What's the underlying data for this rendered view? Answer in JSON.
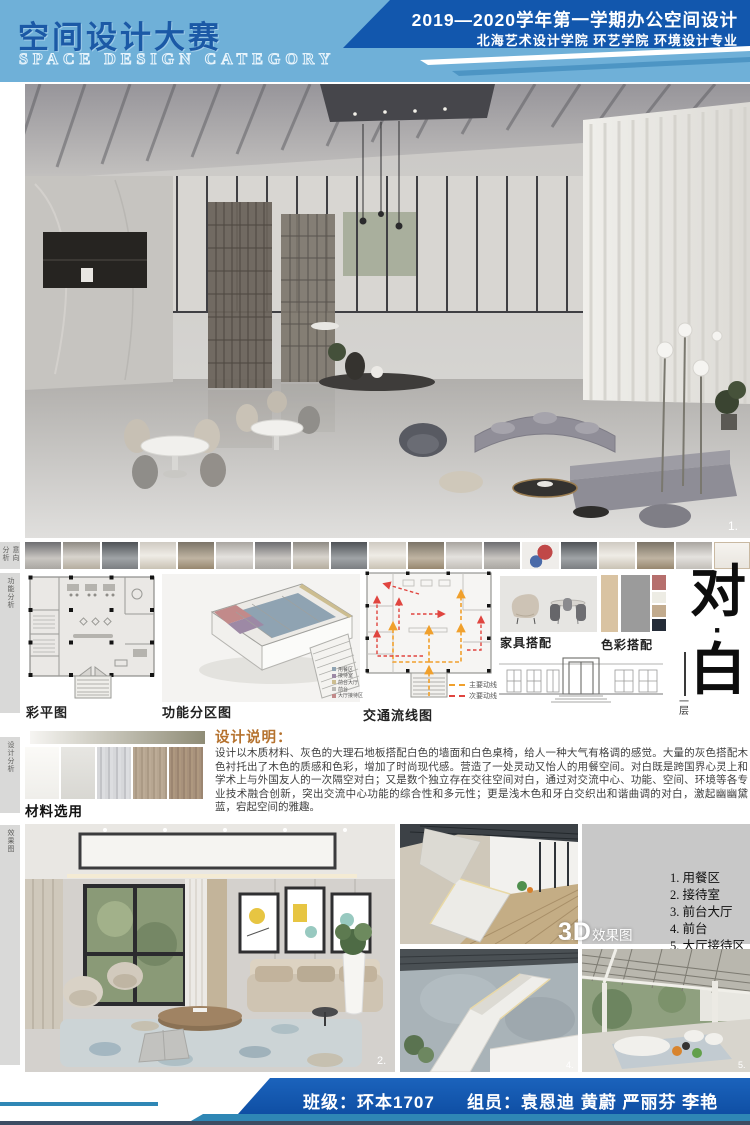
{
  "header": {
    "title_cn": "空间设计大赛",
    "title_en": "SPACE DESIGN CATEGORY",
    "course": "2019—2020学年第一学期办公空间设计",
    "school": "北海艺术设计学院 环艺学院 环境设计专业",
    "colors": {
      "bg_light_blue": "#6fb0d8",
      "band_dark_blue": "#1257ad",
      "title_blue": "#1b59a6"
    }
  },
  "side_tabs": [
    {
      "label": "意向分析"
    },
    {
      "label": "功能分析"
    },
    {
      "label": "设计分析"
    },
    {
      "label": "效果图"
    }
  ],
  "figures": {
    "floor_plan_label": "彩平图",
    "zoning_label": "功能分区图",
    "zoning_legend": [
      {
        "label": "用餐区",
        "color": "#8fa3b2"
      },
      {
        "label": "接待室",
        "color": "#9d89a5"
      },
      {
        "label": "前台大厅",
        "color": "#ccbd90"
      },
      {
        "label": "前台",
        "color": "#b9b8b4"
      },
      {
        "label": "大厅接待区",
        "color": "#c28a8a"
      }
    ],
    "traffic_label": "交通流线图",
    "traffic_legend": [
      {
        "label": "主要动线",
        "color": "#f0a02c"
      },
      {
        "label": "次要动线",
        "color": "#e0453f"
      }
    ],
    "furniture_label": "家具搭配",
    "palette_label": "色彩搭配",
    "palette_large": [
      "#d9c3a2",
      "#9b9b9b"
    ],
    "palette_small": [
      "#b66f6d",
      "#edece4",
      "#c2ab8e",
      "#252c38"
    ]
  },
  "theme": {
    "char_top": "对",
    "dot": "·",
    "char_bottom": "白",
    "floor_note_top": "一",
    "floor_note_bottom": "层"
  },
  "description": {
    "title": "设计说明：",
    "body": "设计以木质材料、灰色的大理石地板搭配白色的墙面和白色桌椅，给人一种大气有格调的感觉。大量的灰色搭配木色衬托出了木色的质感和色彩，增加了时尚现代感。营造了一处灵动又怡人的用餐空间。对白既是跨国界心灵上和学术上与外国友人的一次隔空对白；又是数个独立存在交往空间对白，通过对交流中心、功能、空间、环境等各专业技术融合创新，突出交流中心功能的综合性和多元性；更是浅木色和牙白交织出和谐曲调的对白，激起幽幽黛蓝，宕起空间的雅趣。"
  },
  "materials": {
    "label": "材料选用"
  },
  "renders": {
    "overlay_3d": "3D",
    "overlay_3d_suffix": "效果图",
    "list": [
      "1. 用餐区",
      "2. 接待室",
      "3. 前台大厅",
      "4. 前台",
      "5. 大厅接待区"
    ],
    "numbers": {
      "hero": "1.",
      "living": "2.",
      "corridor": "3.",
      "stair": "4.",
      "patio": "5."
    }
  },
  "footer": {
    "class_info": "班级：环本1707",
    "members": "组员：袁恩迪 黄蔚 严丽芬 李艳"
  }
}
